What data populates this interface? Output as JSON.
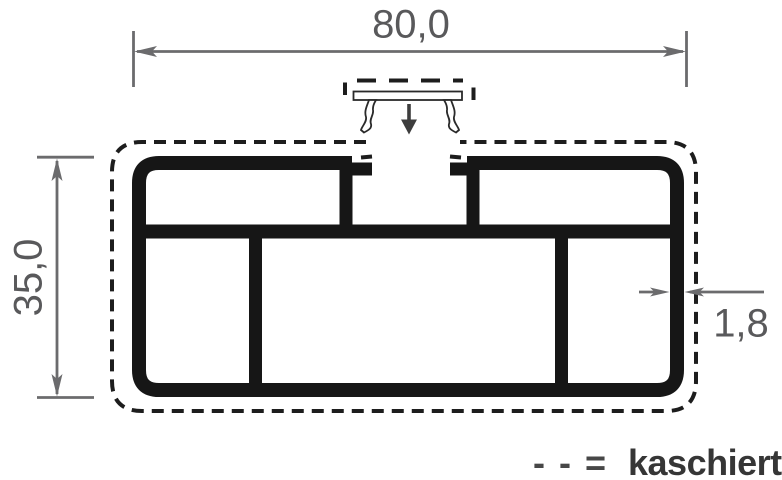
{
  "drawing": {
    "dimension_labels": {
      "width": "80,0",
      "height": "35,0",
      "wall_thickness": "1,8"
    },
    "legend": {
      "symbol": "- - =",
      "label": "kaschiert"
    },
    "icons": {
      "insertion_arrow": "arrow-down"
    },
    "colors": {
      "background": "#ffffff",
      "profile": "#161616",
      "dashed_outline": "#1d1d1d",
      "dimension_line": "#6b6b6d",
      "dimension_text": "#59595b",
      "insertion_arrow": "#3d3d3d",
      "legend_symbol": "#474747",
      "legend_text": "#363636"
    }
  }
}
